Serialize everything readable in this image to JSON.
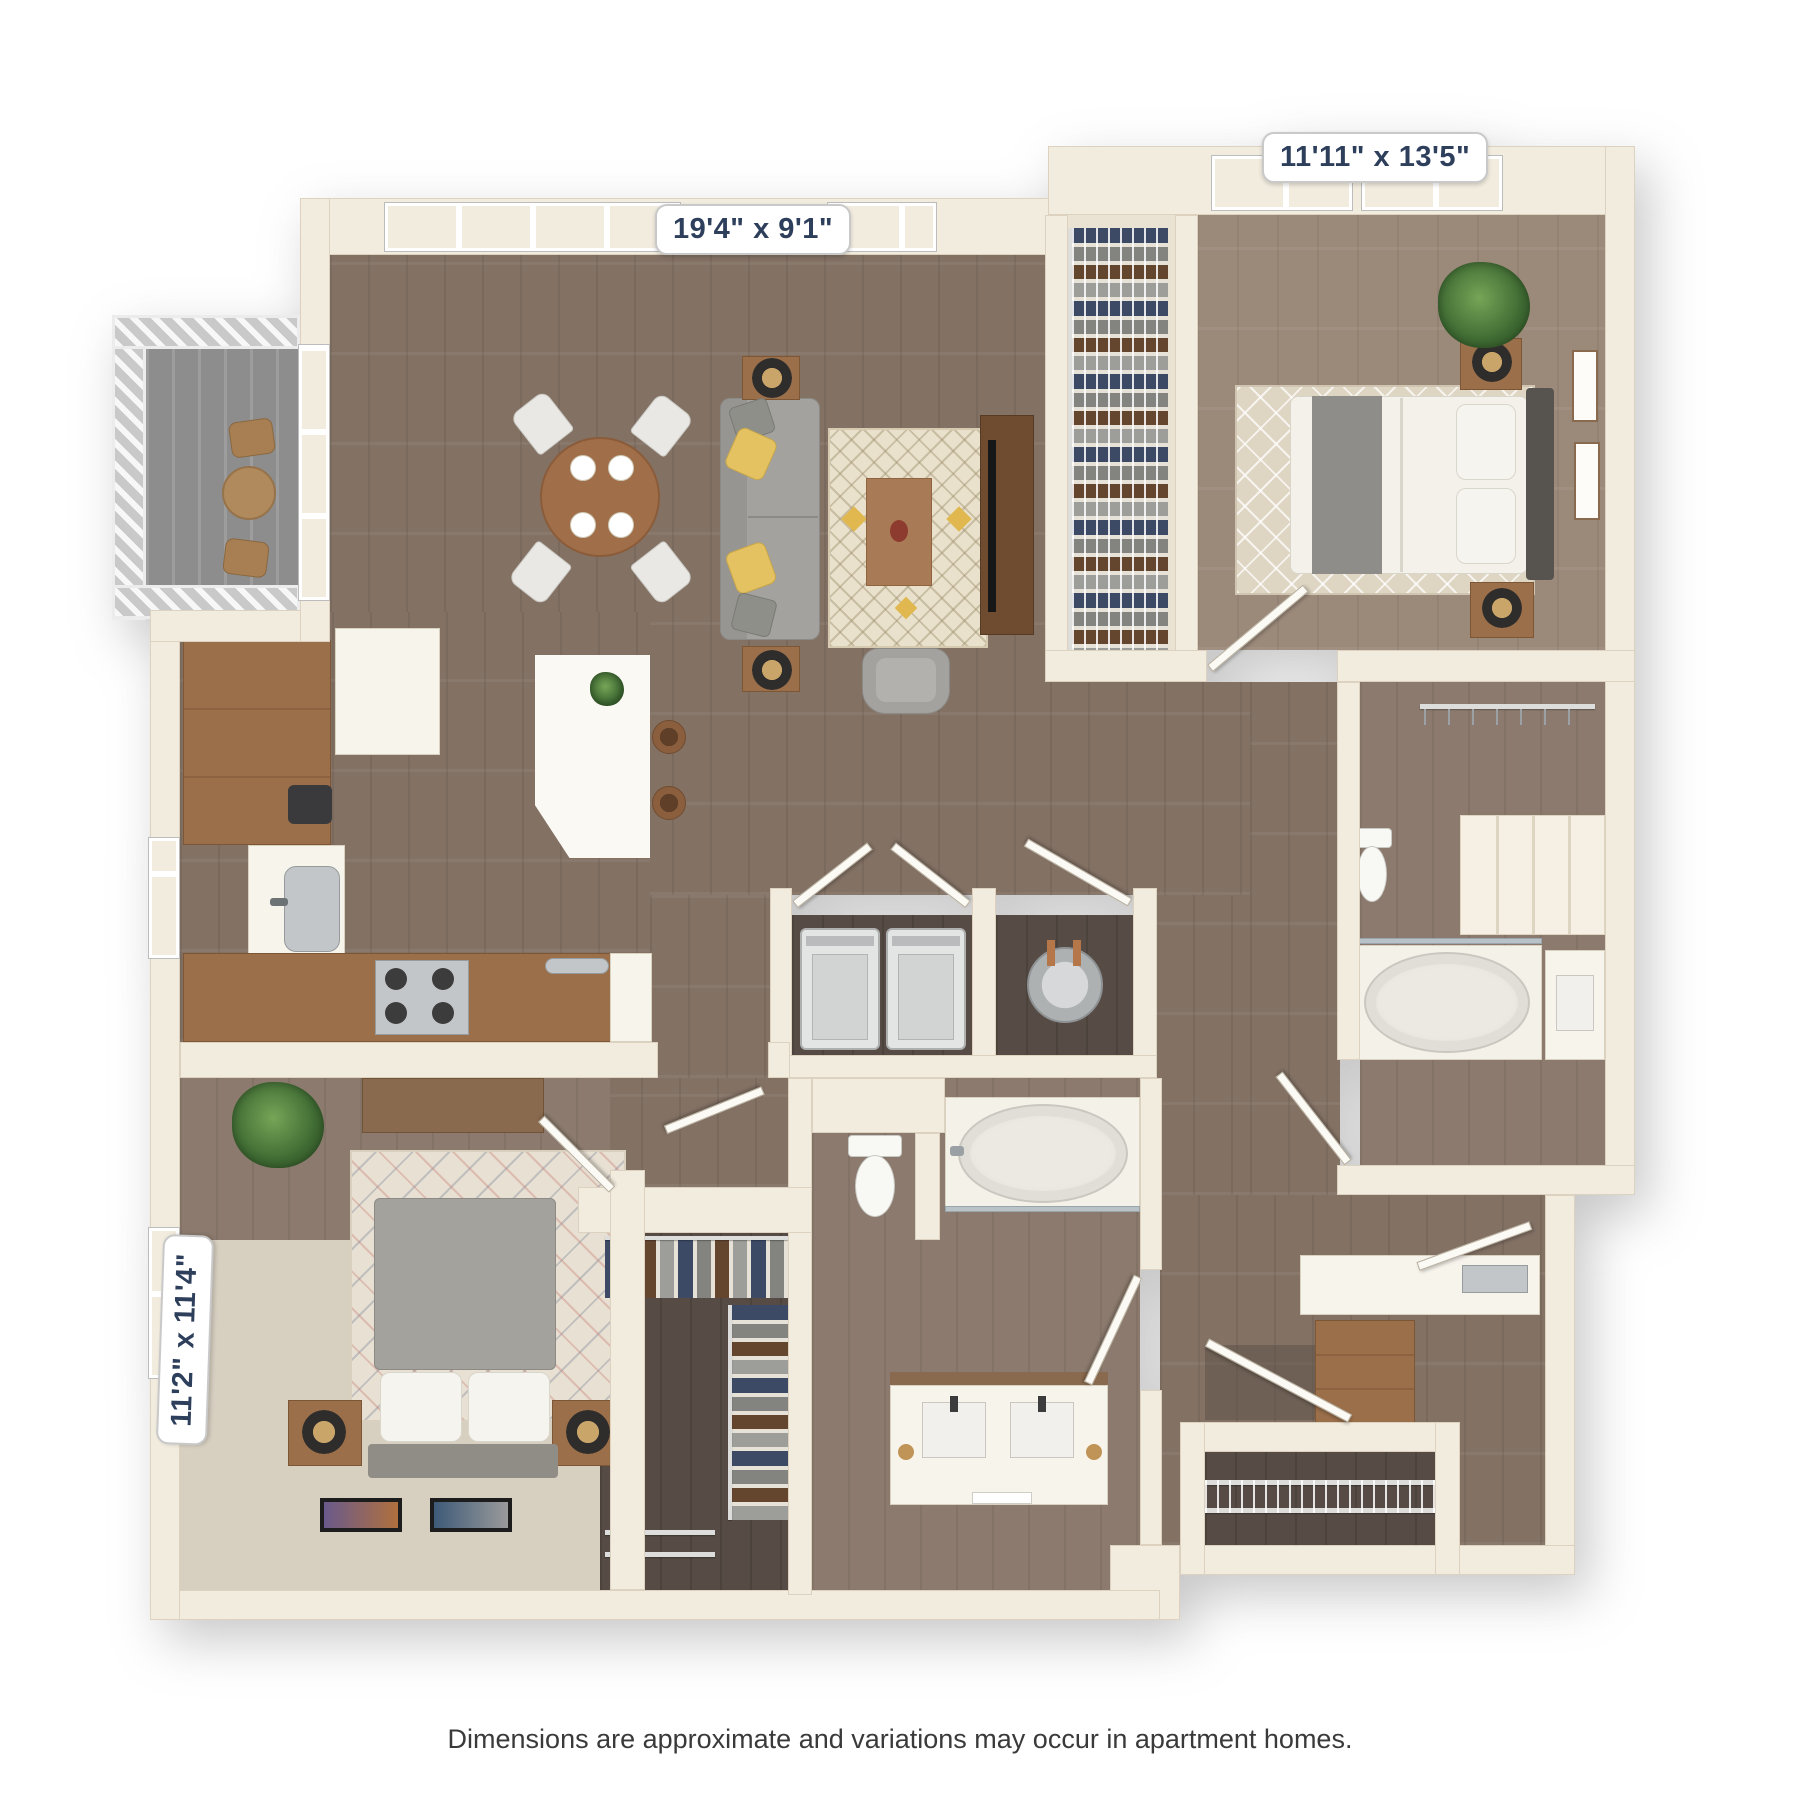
{
  "floor_plan": {
    "type": "apartment-floor-plan-3d-top-view",
    "rooms": {
      "living_dining": {
        "label": "19'4\" x 9'1\""
      },
      "bedroom_primary": {
        "label": "11'11\" x 13'5\""
      },
      "bedroom_secondary": {
        "label": "11'2\" x 11'4\""
      }
    },
    "disclaimer": "Dimensions are approximate and variations may occur in apartment homes.",
    "colors": {
      "label_text": "#2e3f5c",
      "wall": "#f2ecdf",
      "wood_floor": "#837164",
      "accent_yellow": "#e5c261"
    }
  }
}
